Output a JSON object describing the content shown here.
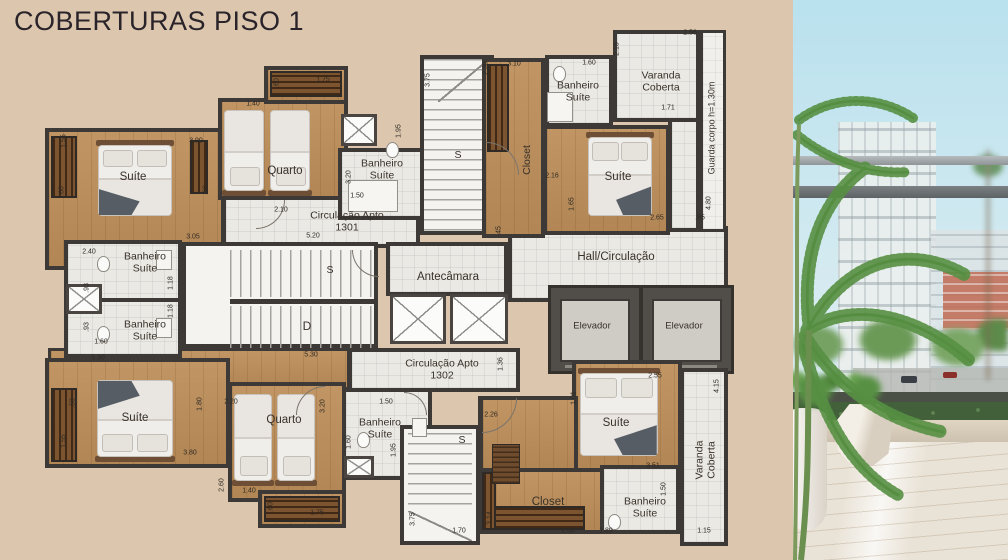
{
  "title": "COBERTURAS PISO 1",
  "colors": {
    "background": "#dcc7ae",
    "wall": "#3d3936",
    "wood": "#bd8f5a",
    "wood_dark": "#7c5530",
    "tile": "#ebe9e4",
    "title_text": "#2a242a",
    "label_text": "#38312a",
    "sky": "#b9e1ee",
    "palm": "#4f8a39",
    "railing": "#6e7374",
    "marble_floor": "#e9e2d6"
  },
  "plan": {
    "rooms": {
      "suite_tl": "Suíte",
      "quarto_top": "Quarto",
      "banheiro_top_mid": "Banheiro Suíte",
      "closet_top": "Closet",
      "banheiro_top_right": "Banheiro Suíte",
      "varanda_top": "Varanda Coberta",
      "guarda_corpo": "Guarda corpo h=1.30m",
      "suite_top_right": "Suíte",
      "circulacao_1301": "Circulação Apto 1301",
      "antecamara": "Antecâmara",
      "hall": "Hall/Circulação",
      "elevador": "Elevador",
      "banheiro_left_1": "Banheiro Suíte",
      "banheiro_left_2": "Banheiro Suíte",
      "stairs_up": "S",
      "stairs_down": "D",
      "circulacao_1302": "Circulação Apto 1302",
      "suite_bl": "Suíte",
      "quarto_bottom": "Quarto",
      "banheiro_bottom_mid": "Banheiro Suíte",
      "suite_br": "Suíte",
      "closet_bottom": "Closet",
      "banheiro_bottom_right": "Banheiro Suíte",
      "varanda_bottom": "Varanda Coberta"
    },
    "dimensions": [
      {
        "t": "1.55",
        "x": 64,
        "y": 141,
        "v": 1
      },
      {
        "t": ".60",
        "x": 62,
        "y": 191,
        "v": 1
      },
      {
        "t": "3.90",
        "x": 196,
        "y": 141
      },
      {
        "t": ".60",
        "x": 206,
        "y": 190,
        "v": 1
      },
      {
        "t": "1.40",
        "x": 253,
        "y": 104
      },
      {
        "t": ".60",
        "x": 277,
        "y": 83,
        "v": 1
      },
      {
        "t": "1.75",
        "x": 323,
        "y": 80
      },
      {
        "t": "3.20",
        "x": 349,
        "y": 177,
        "v": 1
      },
      {
        "t": "1.50",
        "x": 357,
        "y": 196
      },
      {
        "t": "1.95",
        "x": 399,
        "y": 131,
        "v": 1
      },
      {
        "t": "3.75",
        "x": 428,
        "y": 80,
        "v": 1
      },
      {
        "t": "2.10",
        "x": 281,
        "y": 210
      },
      {
        "t": "5.20",
        "x": 313,
        "y": 236
      },
      {
        "t": "3.05",
        "x": 193,
        "y": 237
      },
      {
        "t": "2.40",
        "x": 89,
        "y": 252
      },
      {
        "t": ".93",
        "x": 87,
        "y": 288,
        "v": 1
      },
      {
        "t": "1.18",
        "x": 171,
        "y": 283,
        "v": 1
      },
      {
        "t": ".93",
        "x": 87,
        "y": 327,
        "v": 1
      },
      {
        "t": "1.18",
        "x": 171,
        "y": 311,
        "v": 1
      },
      {
        "t": "1.60",
        "x": 101,
        "y": 342
      },
      {
        "t": "5.30",
        "x": 98,
        "y": 358
      },
      {
        "t": "2.30",
        "x": 486,
        "y": 68,
        "v": 1
      },
      {
        "t": "3.10",
        "x": 514,
        "y": 64
      },
      {
        "t": "1.60",
        "x": 589,
        "y": 63
      },
      {
        "t": "2.15",
        "x": 617,
        "y": 49,
        "v": 1
      },
      {
        "t": "2.56",
        "x": 690,
        "y": 33
      },
      {
        "t": "1.71",
        "x": 668,
        "y": 108
      },
      {
        "t": "4.80",
        "x": 709,
        "y": 203,
        "v": 1
      },
      {
        "t": ".85",
        "x": 700,
        "y": 218
      },
      {
        "t": "2.16",
        "x": 552,
        "y": 176
      },
      {
        "t": "1.65",
        "x": 572,
        "y": 204,
        "v": 1
      },
      {
        "t": "2.65",
        "x": 657,
        "y": 218
      },
      {
        "t": ".45",
        "x": 499,
        "y": 231,
        "v": 1
      },
      {
        "t": "5.30",
        "x": 311,
        "y": 355
      },
      {
        "t": "1.36",
        "x": 501,
        "y": 364,
        "v": 1
      },
      {
        "t": ".50",
        "x": 73,
        "y": 403,
        "v": 1
      },
      {
        "t": "1.80",
        "x": 200,
        "y": 404,
        "v": 1
      },
      {
        "t": "2.20",
        "x": 231,
        "y": 402
      },
      {
        "t": "1.55",
        "x": 64,
        "y": 441,
        "v": 1
      },
      {
        "t": "3.80",
        "x": 190,
        "y": 453
      },
      {
        "t": "3.20",
        "x": 323,
        "y": 406,
        "v": 1
      },
      {
        "t": "2.60",
        "x": 222,
        "y": 485,
        "v": 1
      },
      {
        "t": "1.40",
        "x": 249,
        "y": 491
      },
      {
        "t": ".60",
        "x": 271,
        "y": 507,
        "v": 1
      },
      {
        "t": "1.75",
        "x": 317,
        "y": 513
      },
      {
        "t": "1.50",
        "x": 386,
        "y": 402
      },
      {
        "t": "1.60",
        "x": 349,
        "y": 442,
        "v": 1
      },
      {
        "t": "1.95",
        "x": 394,
        "y": 450,
        "v": 1
      },
      {
        "t": "3.75",
        "x": 413,
        "y": 519,
        "v": 1
      },
      {
        "t": "1.70",
        "x": 459,
        "y": 531
      },
      {
        "t": "2.55",
        "x": 655,
        "y": 376
      },
      {
        "t": "1.01",
        "x": 574,
        "y": 398,
        "v": 1
      },
      {
        "t": "2.26",
        "x": 491,
        "y": 415
      },
      {
        "t": "3.51",
        "x": 653,
        "y": 466
      },
      {
        "t": "4.15",
        "x": 717,
        "y": 386,
        "v": 1
      },
      {
        "t": "3.14",
        "x": 490,
        "y": 518,
        "v": 1
      },
      {
        "t": "2.66",
        "x": 568,
        "y": 531
      },
      {
        "t": "1.89",
        "x": 606,
        "y": 531
      },
      {
        "t": "1.50",
        "x": 664,
        "y": 489,
        "v": 1
      },
      {
        "t": "1.15",
        "x": 704,
        "y": 531
      }
    ]
  }
}
